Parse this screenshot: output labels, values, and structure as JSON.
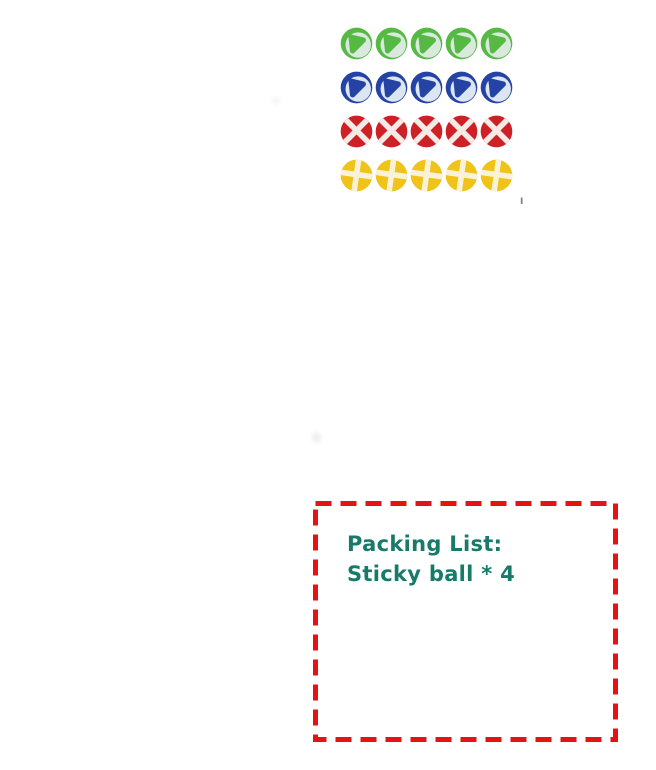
{
  "page": {
    "background": "#ffffff"
  },
  "product_display": {
    "grid": {
      "rows": 4,
      "columns": 5
    },
    "balls": [
      {
        "name": "green",
        "main": "#55b944",
        "band": "#d9e9de",
        "pattern": "triangle-band"
      },
      {
        "name": "blue",
        "main": "#2543a4",
        "band": "#dce6f1",
        "pattern": "triangle-band"
      },
      {
        "name": "red",
        "main": "#cd2128",
        "band": "#f6eae7",
        "pattern": "cross-band",
        "stripe_angles": [
          45,
          -45
        ]
      },
      {
        "name": "yellow",
        "main": "#f0c318",
        "band": "#f9f1d8",
        "pattern": "cross-band",
        "stripe_angles": [
          8,
          98
        ]
      }
    ],
    "tick_mark": "I"
  },
  "packing_box": {
    "title": "Packing List:",
    "item": "Sticky ball * 4",
    "text_color": "#187a68",
    "border_color": "#e51414"
  }
}
